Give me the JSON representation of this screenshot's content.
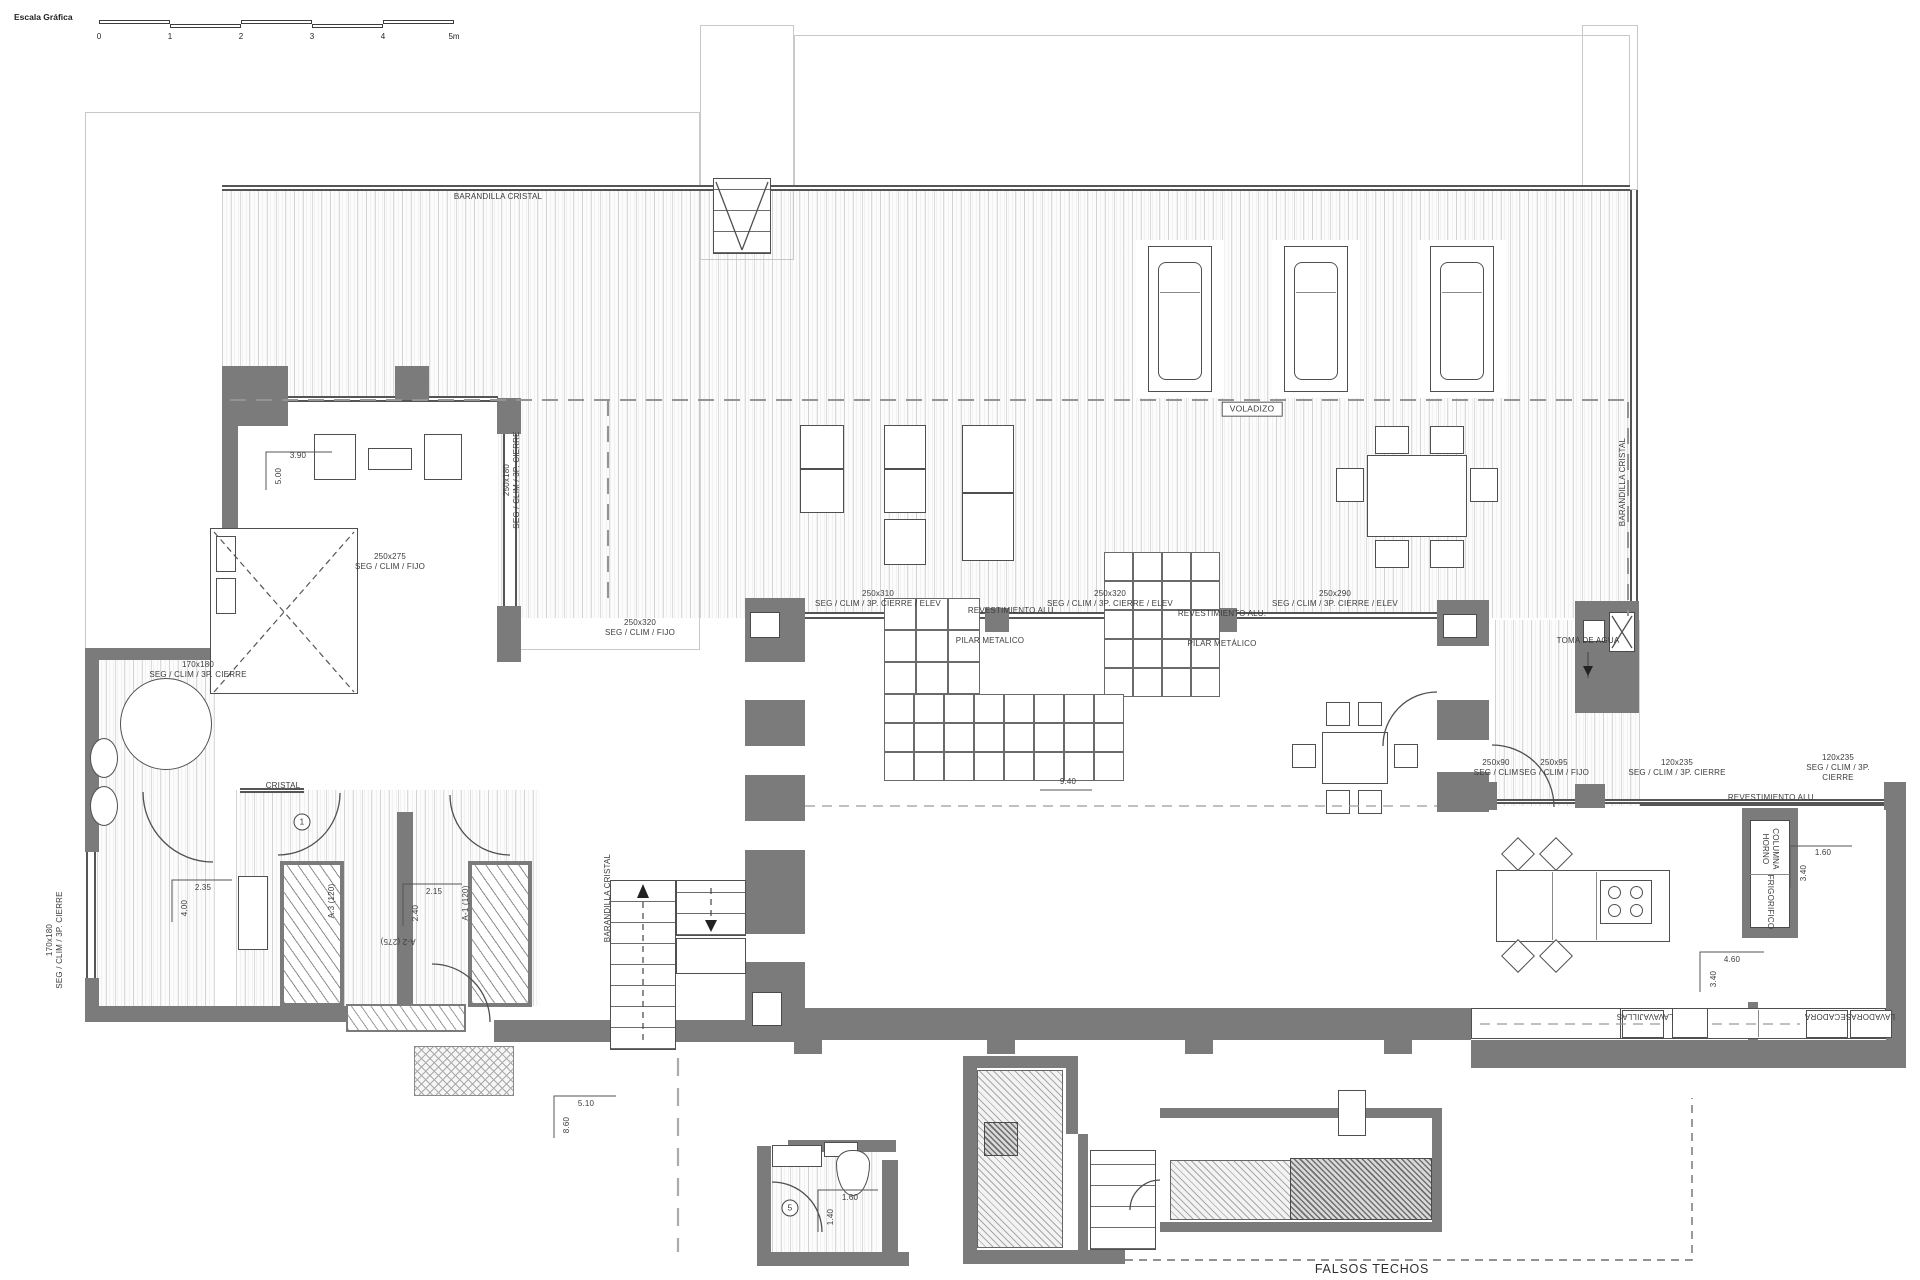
{
  "scale_bar": {
    "label": "Escala Gráfica",
    "ticks": [
      "0",
      "1",
      "2",
      "3",
      "4",
      "5m"
    ]
  },
  "colors": {
    "wall": "#7b7b7b",
    "line": "#4a4a4a",
    "dash": "#969696"
  },
  "annotations": [
    {
      "t": "BARANDILLA CRISTAL",
      "x": 498,
      "y": 197
    },
    {
      "t": "250x275\nSEG / CLIM / FIJO",
      "x": 390,
      "y": 562
    },
    {
      "t": "250x180\nSEG / CLIM / 3P. CIERRE",
      "x": 512,
      "y": 480,
      "r": -90
    },
    {
      "t": "VOLADIZO",
      "x": 1252,
      "y": 409,
      "cls": "boxed"
    },
    {
      "t": "BARANDILLA CRISTAL",
      "x": 1623,
      "y": 482,
      "r": -90
    },
    {
      "t": "250x310\nSEG / CLIM / 3P. CIERRE / ELEV",
      "x": 878,
      "y": 599
    },
    {
      "t": "250x320\nSEG / CLIM / 3P. CIERRE / ELEV",
      "x": 1110,
      "y": 599
    },
    {
      "t": "250x290\nSEG / CLIM / 3P. CIERRE / ELEV",
      "x": 1335,
      "y": 599
    },
    {
      "t": "REVESTIMIENTO ALU.",
      "x": 1012,
      "y": 611
    },
    {
      "t": "PILAR METALICO",
      "x": 990,
      "y": 641
    },
    {
      "t": "REVESTIMIENTO ALU.",
      "x": 1222,
      "y": 614
    },
    {
      "t": "PILAR METÁLICO",
      "x": 1222,
      "y": 644
    },
    {
      "t": "TOMA DE AGUA",
      "x": 1588,
      "y": 641
    },
    {
      "t": "170x180\nSEG / CLIM / 3P. CIERRE",
      "x": 198,
      "y": 670
    },
    {
      "t": "250x320\nSEG / CLIM / FIJO",
      "x": 640,
      "y": 628
    },
    {
      "t": "CRISTAL",
      "x": 283,
      "y": 786
    },
    {
      "t": "170x180\nSEG / CLIM / 3P. CIERRE",
      "x": 55,
      "y": 940,
      "r": -90
    },
    {
      "t": "3.90",
      "x": 298,
      "y": 456
    },
    {
      "t": "5.00",
      "x": 279,
      "y": 476,
      "r": -90
    },
    {
      "t": "2.35",
      "x": 203,
      "y": 888
    },
    {
      "t": "4.00",
      "x": 185,
      "y": 908,
      "r": -90
    },
    {
      "t": "2.15",
      "x": 434,
      "y": 892
    },
    {
      "t": "2.40",
      "x": 416,
      "y": 913,
      "r": -90
    },
    {
      "t": "A.3 (120)",
      "x": 332,
      "y": 901,
      "r": -90
    },
    {
      "t": "A-1 (120)",
      "x": 466,
      "y": 903,
      "r": -90
    },
    {
      "t": "A-2 (275)",
      "x": 398,
      "y": 941,
      "r": 180
    },
    {
      "t": "1",
      "x": 302,
      "y": 822,
      "cls": "circle"
    },
    {
      "t": "BARANDILLA CRISTAL",
      "x": 608,
      "y": 898,
      "r": -90
    },
    {
      "t": "5.10",
      "x": 586,
      "y": 1104
    },
    {
      "t": "8.60",
      "x": 567,
      "y": 1125,
      "r": -90
    },
    {
      "t": "9.40",
      "x": 1068,
      "y": 782
    },
    {
      "t": "250x90\nSEG / CLIM",
      "x": 1496,
      "y": 768
    },
    {
      "t": "250x95\nSEG / CLIM / FIJO",
      "x": 1554,
      "y": 768
    },
    {
      "t": "120x235\nSEG / CLIM / 3P. CIERRE",
      "x": 1677,
      "y": 768
    },
    {
      "t": "120x235\nSEG / CLIM / 3P. CIERRE",
      "x": 1838,
      "y": 768
    },
    {
      "t": "REVESTIMIENTO ALU.",
      "x": 1772,
      "y": 798
    },
    {
      "t": "COLUMNA\nHORNO",
      "x": 1770,
      "y": 849,
      "r": 90
    },
    {
      "t": "FRIGORIFICO",
      "x": 1770,
      "y": 902,
      "r": 90
    },
    {
      "t": "1.60",
      "x": 1823,
      "y": 853
    },
    {
      "t": "3.40",
      "x": 1804,
      "y": 873,
      "r": -90
    },
    {
      "t": "4.60",
      "x": 1732,
      "y": 960
    },
    {
      "t": "3.40",
      "x": 1714,
      "y": 979,
      "r": -90
    },
    {
      "t": "LAVAVAJILLAS",
      "x": 1645,
      "y": 1016,
      "r": 180
    },
    {
      "t": "SECADORA",
      "x": 1828,
      "y": 1016,
      "r": 180
    },
    {
      "t": "LAVADORA",
      "x": 1873,
      "y": 1016,
      "r": 180
    },
    {
      "t": "1.60",
      "x": 850,
      "y": 1198
    },
    {
      "t": "1.40",
      "x": 831,
      "y": 1217,
      "r": -90
    },
    {
      "t": "5",
      "x": 790,
      "y": 1208,
      "cls": "circle"
    },
    {
      "t": "FALSOS TECHOS",
      "x": 1372,
      "y": 1270,
      "cls": "big"
    }
  ]
}
